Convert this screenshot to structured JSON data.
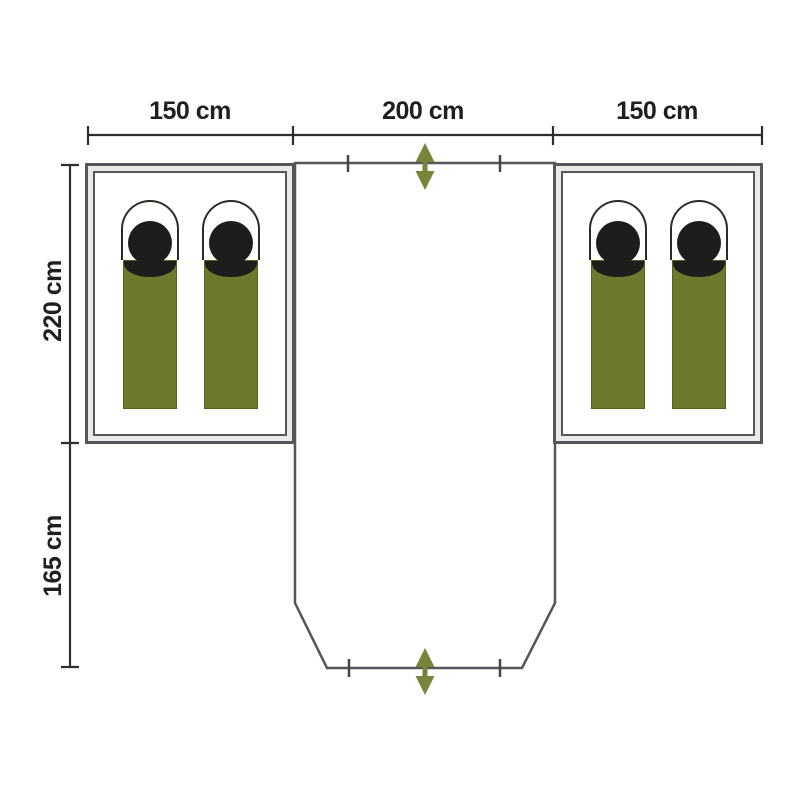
{
  "diagram": {
    "kind": "tent floor plan",
    "labels": {
      "left_cabin_width": "150 cm",
      "porch_width": "200 cm",
      "right_cabin_width": "150 cm",
      "cabin_depth": "220 cm",
      "canopy_depth": "165 cm"
    },
    "cabins": [
      {
        "side": "left",
        "sleeping_bags": 2
      },
      {
        "side": "right",
        "sleeping_bags": 2
      }
    ],
    "entrance_arrows": 2,
    "colors": {
      "outline": "#54565A",
      "dimension_line": "#2e2e2e",
      "label_text": "#1f1f1f",
      "sleeping_bag_green": "#6B7A2C",
      "arrow_green": "#77853B",
      "head_black": "#1D1D1B",
      "background": "#FFFFFF"
    }
  }
}
